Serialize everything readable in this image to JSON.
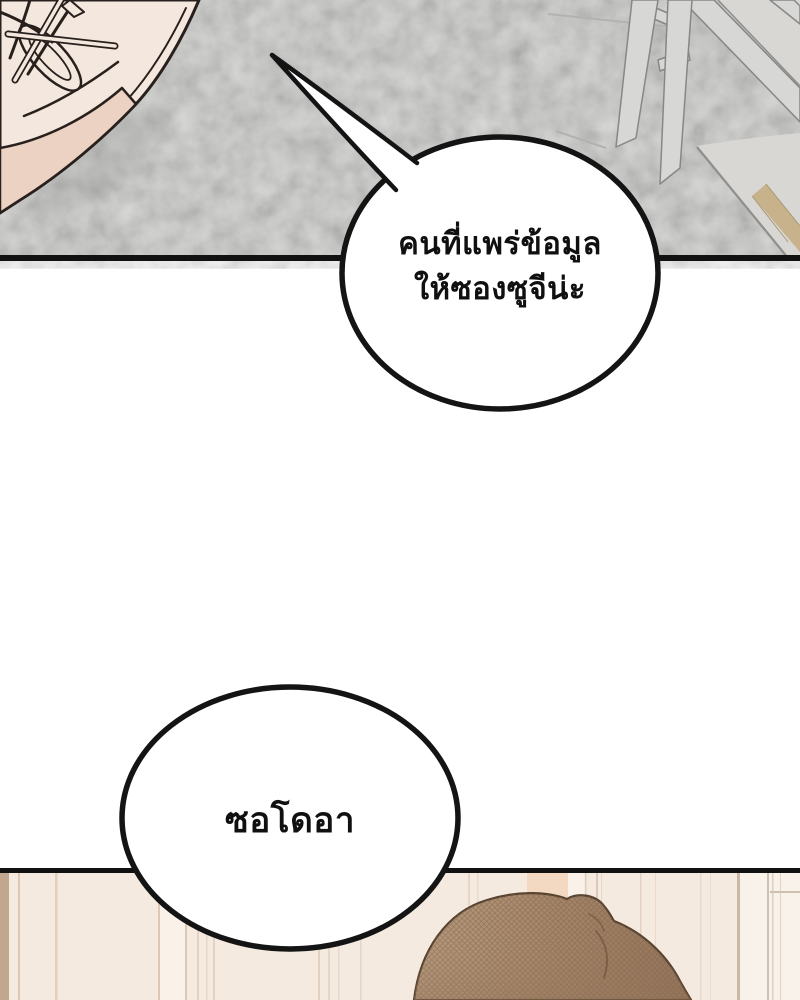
{
  "comic": {
    "bubbles": [
      {
        "id": "bubble-info-leak",
        "lines": [
          "คนที่แพร่ข้อมูล",
          "ให้ซองซูจีน่ะ"
        ]
      },
      {
        "id": "bubble-name",
        "lines": [
          "ซอโดอา"
        ]
      }
    ]
  },
  "colors": {
    "panel-border": "#111111",
    "bubble-outline": "#141414",
    "bubble-fill": "#ffffff",
    "text-color": "#101010",
    "carpet-base": "#cbcbc9",
    "floor-gray": "#d8d7d4",
    "floor-trim-tan": "#c7b28c",
    "floor-edge-line": "#8f8f8d",
    "chair-fill": "#d7d7d5",
    "chair-outline": "#878785",
    "seam-line": "#b2b2b0",
    "shoe-fill": "#f4e8de",
    "shoe-sole": "#ecd2c3",
    "shoe-outline": "#28201c",
    "wall-base": "#f4eadf",
    "wall-strip-dark": "#c2a78f",
    "wall-strip-light": "#faf2e8",
    "wall-peach": "#f3d9c2",
    "wall-line": "#dcc8b5",
    "door-panel": "#f8f2ea",
    "door-line": "#c9b8a5",
    "hair-light": "#b79b7e",
    "hair-base": "#a8886b",
    "hair-shadow": "#93745a",
    "hair-outline": "#57422f",
    "hair-hatch": "#7e6149"
  }
}
